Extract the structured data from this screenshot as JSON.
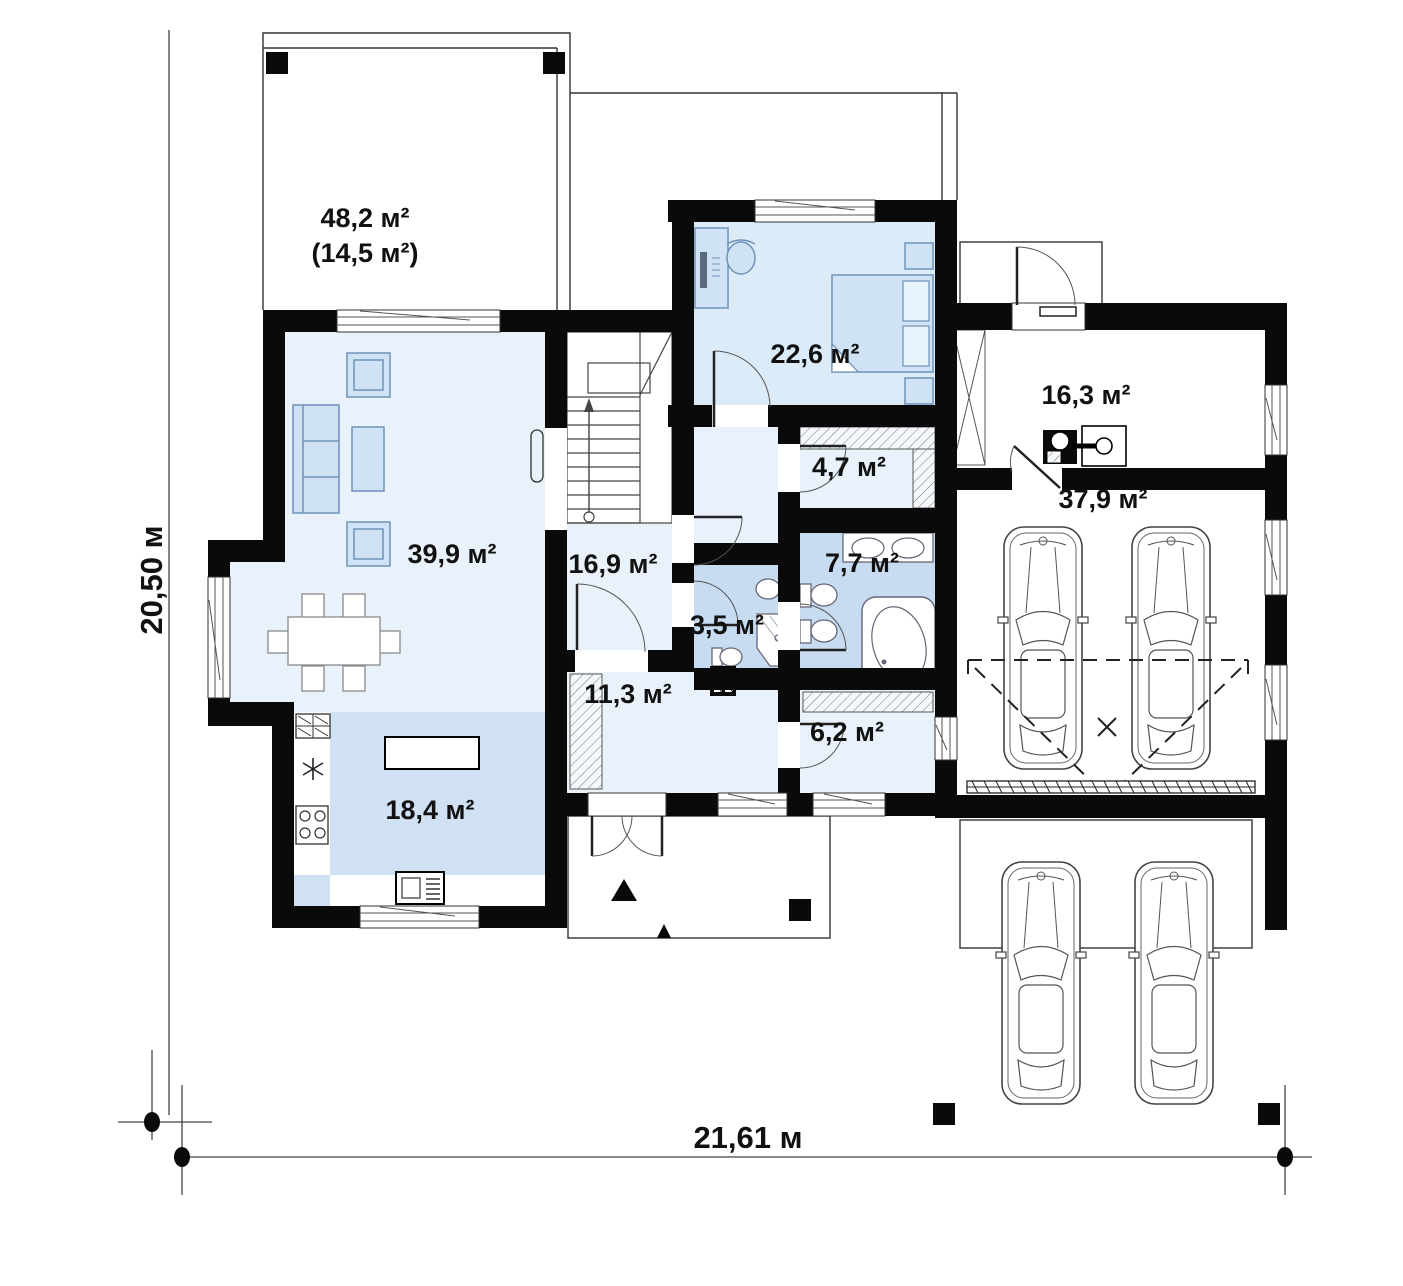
{
  "plan": {
    "type": "architectural-floor-plan",
    "dimensions": {
      "vertical": "20,50 м",
      "horizontal": "21,61 м"
    },
    "rooms": {
      "terrace": {
        "area": "48,2 м²",
        "area_secondary": "(14,5 м²)"
      },
      "living_room": {
        "area": "39,9 м²"
      },
      "bedroom": {
        "area": "22,6 м²"
      },
      "boiler_room": {
        "area": "16,3 м²"
      },
      "wardrobe": {
        "area": "4,7 м²"
      },
      "hall": {
        "area": "16,9 м²"
      },
      "bathroom": {
        "area": "7,7 м²"
      },
      "wc": {
        "area": "3,5 м²"
      },
      "garage": {
        "area": "37,9 м²"
      },
      "entry_hall": {
        "area": "11,3 м²"
      },
      "utility_room": {
        "area": "6,2 м²"
      },
      "kitchen": {
        "area": "18,4 м²"
      }
    },
    "colors": {
      "wall": "#0a0a0a",
      "room_light": "#e9f2fb",
      "room_bedroom": "#dcebf8",
      "room_medium": "#c7dcf0",
      "furniture_fill": "#cfe3f5",
      "furniture_stroke": "#6f93b8",
      "thin_line": "#333333"
    }
  }
}
